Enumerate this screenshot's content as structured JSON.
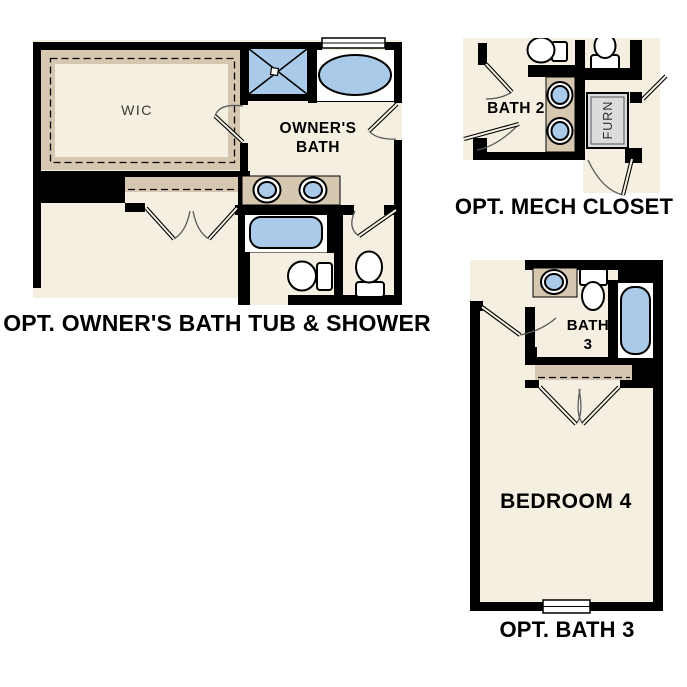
{
  "colors": {
    "cream": "#f5efe2",
    "tan": "#d6c8b0",
    "blue": "#a9cae8",
    "wall": "#000000",
    "furn_gray": "#dcdcdc"
  },
  "plans": [
    {
      "id": "owners-bath",
      "title": "OPT. OWNER'S BATH TUB & SHOWER",
      "labels": {
        "wic": "WIC",
        "bath_line1": "OWNER'S",
        "bath_line2": "BATH"
      }
    },
    {
      "id": "mech-closet",
      "title": "OPT. MECH CLOSET",
      "labels": {
        "bath2": "BATH 2",
        "furn": "FURN"
      }
    },
    {
      "id": "bath3",
      "title": "OPT. BATH 3",
      "labels": {
        "bath_line1": "BATH",
        "bath_line2": "3",
        "bedroom": "BEDROOM 4"
      }
    }
  ]
}
